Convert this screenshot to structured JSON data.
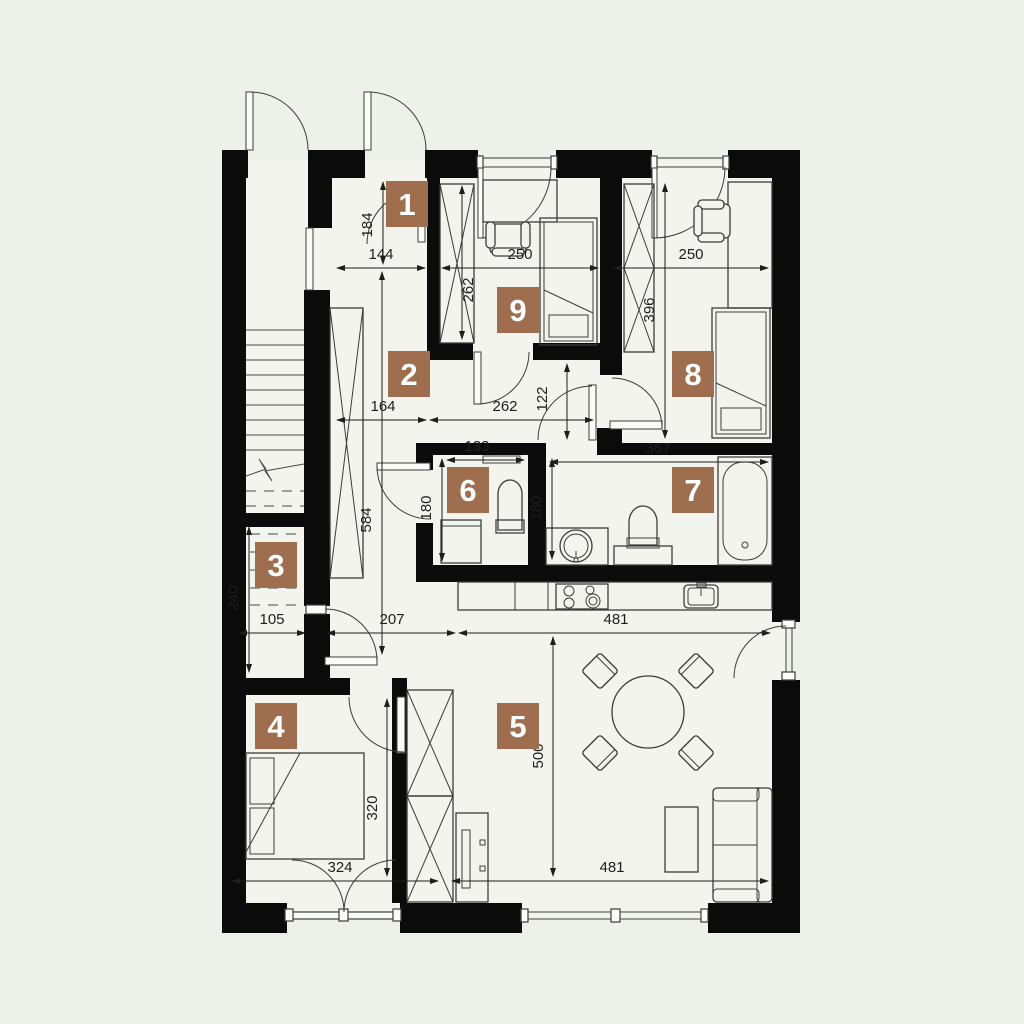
{
  "colors": {
    "background": "#eef0ea",
    "floor": "#f3f4ee",
    "wall": "#0b0b0b",
    "furniture_line": "#3c3c3c",
    "dimension_line": "#1e1e1e",
    "label_bg": "#9e6e4f",
    "label_text": "#ffffff"
  },
  "room_labels": [
    {
      "number": "1",
      "cx": 407,
      "cy": 204
    },
    {
      "number": "2",
      "cx": 409,
      "cy": 374
    },
    {
      "number": "3",
      "cx": 276,
      "cy": 565
    },
    {
      "number": "4",
      "cx": 276,
      "cy": 726
    },
    {
      "number": "5",
      "cx": 518,
      "cy": 726
    },
    {
      "number": "6",
      "cx": 468,
      "cy": 490
    },
    {
      "number": "7",
      "cx": 693,
      "cy": 490
    },
    {
      "number": "8",
      "cx": 693,
      "cy": 374
    },
    {
      "number": "9",
      "cx": 518,
      "cy": 310
    }
  ],
  "dimensions": [
    {
      "value": "184",
      "x1": 383,
      "y1": 182,
      "x2": 383,
      "y2": 264,
      "tx": 372,
      "ty": 225,
      "rot": true
    },
    {
      "value": "144",
      "x1": 337,
      "y1": 268,
      "x2": 425,
      "y2": 268,
      "tx": 381,
      "ty": 259,
      "rot": false
    },
    {
      "value": "250",
      "x1": 442,
      "y1": 268,
      "x2": 598,
      "y2": 268,
      "tx": 520,
      "ty": 259,
      "rot": false
    },
    {
      "value": "250",
      "x1": 614,
      "y1": 268,
      "x2": 768,
      "y2": 268,
      "tx": 691,
      "ty": 259,
      "rot": false
    },
    {
      "value": "262",
      "x1": 462,
      "y1": 186,
      "x2": 462,
      "y2": 339,
      "tx": 473,
      "ty": 290,
      "rot": true
    },
    {
      "value": "396",
      "x1": 665,
      "y1": 184,
      "x2": 665,
      "y2": 438,
      "tx": 654,
      "ty": 310,
      "rot": true
    },
    {
      "value": "164",
      "x1": 337,
      "y1": 420,
      "x2": 426,
      "y2": 420,
      "tx": 383,
      "ty": 411,
      "rot": false
    },
    {
      "value": "262",
      "x1": 430,
      "y1": 420,
      "x2": 593,
      "y2": 420,
      "tx": 505,
      "ty": 411,
      "rot": false
    },
    {
      "value": "122",
      "x1": 567,
      "y1": 364,
      "x2": 567,
      "y2": 439,
      "tx": 547,
      "ty": 399,
      "rot": true
    },
    {
      "value": "584",
      "x1": 382,
      "y1": 272,
      "x2": 382,
      "y2": 654,
      "tx": 371,
      "ty": 520,
      "rot": true
    },
    {
      "value": "133",
      "x1": 447,
      "y1": 460,
      "x2": 524,
      "y2": 460,
      "tx": 477,
      "ty": 451,
      "rot": false
    },
    {
      "value": "367",
      "x1": 550,
      "y1": 462,
      "x2": 768,
      "y2": 462,
      "tx": 658,
      "ty": 453,
      "rot": false
    },
    {
      "value": "180",
      "x1": 442,
      "y1": 459,
      "x2": 442,
      "y2": 561,
      "tx": 431,
      "ty": 508,
      "rot": true
    },
    {
      "value": "180",
      "x1": 552,
      "y1": 459,
      "x2": 552,
      "y2": 559,
      "tx": 541,
      "ty": 508,
      "rot": true
    },
    {
      "value": "240",
      "x1": 249,
      "y1": 527,
      "x2": 249,
      "y2": 672,
      "tx": 238,
      "ty": 598,
      "rot": true
    },
    {
      "value": "105",
      "x1": 239,
      "y1": 633,
      "x2": 305,
      "y2": 633,
      "tx": 272,
      "ty": 624,
      "rot": false
    },
    {
      "value": "207",
      "x1": 327,
      "y1": 633,
      "x2": 455,
      "y2": 633,
      "tx": 392,
      "ty": 624,
      "rot": false
    },
    {
      "value": "481",
      "x1": 459,
      "y1": 633,
      "x2": 770,
      "y2": 633,
      "tx": 616,
      "ty": 624,
      "rot": false
    },
    {
      "value": "320",
      "x1": 387,
      "y1": 699,
      "x2": 387,
      "y2": 876,
      "tx": 377,
      "ty": 808,
      "rot": true
    },
    {
      "value": "500",
      "x1": 553,
      "y1": 637,
      "x2": 553,
      "y2": 876,
      "tx": 543,
      "ty": 756,
      "rot": true
    },
    {
      "value": "324",
      "x1": 232,
      "y1": 881,
      "x2": 438,
      "y2": 881,
      "tx": 340,
      "ty": 872,
      "rot": false
    },
    {
      "value": "481",
      "x1": 452,
      "y1": 881,
      "x2": 768,
      "y2": 881,
      "tx": 612,
      "ty": 872,
      "rot": false
    }
  ],
  "furniture_icons": [
    "stairs",
    "wardrobe",
    "single-bed",
    "desk",
    "desk-chair",
    "double-bed",
    "bathtub",
    "toilet",
    "washbasin",
    "washing-machine",
    "shelf",
    "kitchen-hob",
    "kitchen-sink",
    "dining-table",
    "dining-chair",
    "sofa",
    "coffee-table",
    "tv-cabinet",
    "door-swing",
    "window"
  ]
}
